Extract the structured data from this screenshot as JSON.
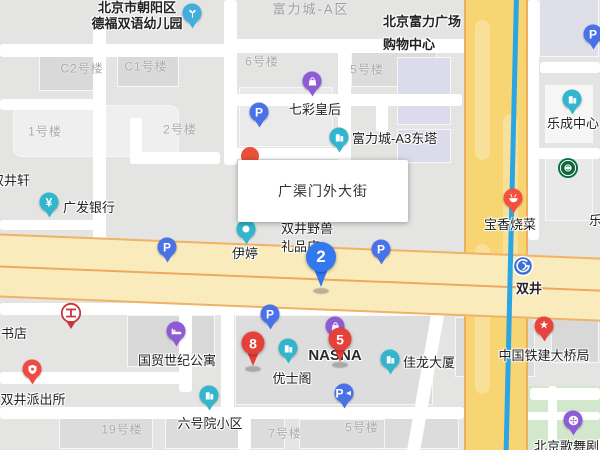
{
  "info_box": {
    "text": "广渠门外大街"
  },
  "colors": {
    "land": "#E4E4E3",
    "road_white": "#FFFFFF",
    "main_road_fill": "#F7D573",
    "main_road_casing": "#EFAF62",
    "cross_road_fill": "#FAEBBC",
    "road_centerline": "#EDA95E",
    "subway_line_blue": "#2AA6E4",
    "park_green": "#D2E7CC",
    "poi_teal": "#32B6CE",
    "poi_purple": "#8F5AD6",
    "parking_blue": "#4A72E8",
    "marker_red": "#E6403A",
    "marker_blue": "#3478F0",
    "icbc_red": "#C8353A",
    "starbucks_green": "#0A6C3C",
    "subway_icon_blue": "#3B6FD6",
    "building_label_gray": "#ABABAB"
  },
  "area_labels": [
    {
      "text": "富力城-A区",
      "x": 311,
      "y": 8
    }
  ],
  "building_labels": [
    {
      "text": "C2号楼",
      "x": 82,
      "y": 68
    },
    {
      "text": "C1号楼",
      "x": 146,
      "y": 66
    },
    {
      "text": "1号楼",
      "x": 45,
      "y": 131
    },
    {
      "text": "2号楼",
      "x": 180,
      "y": 129
    },
    {
      "text": "6号楼",
      "x": 262,
      "y": 61
    },
    {
      "text": "5号楼",
      "x": 367,
      "y": 69
    },
    {
      "text": "19号楼",
      "x": 122,
      "y": 429
    },
    {
      "text": "7号楼",
      "x": 285,
      "y": 433
    },
    {
      "text": "5号楼",
      "x": 362,
      "y": 427
    }
  ],
  "pois": [
    {
      "name": "北京市朝阳区\n德福双语幼儿园",
      "icon": "kindergarten",
      "color": "#41AEDC",
      "x": 192,
      "y": 13,
      "label_x": 137,
      "label_y": 16,
      "align": "center",
      "bold": true,
      "lh": 16
    },
    {
      "name": "七彩皇后",
      "icon": "shopping-bag",
      "color": "#8F5AD6",
      "x": 312,
      "y": 81,
      "label_x": 315,
      "label_y": 110,
      "align": "center"
    },
    {
      "name": "北京富力广场\n购物中心",
      "icon": "",
      "label_x": 383,
      "label_y": 33,
      "align": "left",
      "bold": true,
      "lh": 23
    },
    {
      "name": "富力城-A3东塔",
      "icon": "building",
      "color": "#32B6CE",
      "x": 339,
      "y": 137,
      "label_x": 352,
      "label_y": 139,
      "align": "left"
    },
    {
      "name": "乐成中心",
      "icon": "building",
      "color": "#32B6CE",
      "x": 572,
      "y": 99,
      "label_x": 573,
      "label_y": 124,
      "align": "center"
    },
    {
      "name": "",
      "icon": "starbucks",
      "x": 568,
      "y": 168
    },
    {
      "name": "双井轩",
      "icon": "",
      "label_x": -9,
      "label_y": 181,
      "align": "left"
    },
    {
      "name": "广发银行",
      "icon": "yuan",
      "color": "#32B6CE",
      "x": 49,
      "y": 202,
      "label_x": 63,
      "label_y": 208,
      "align": "left"
    },
    {
      "name": "伊婷",
      "icon": "dot",
      "color": "#32B6CE",
      "x": 246,
      "y": 229,
      "label_x": 245,
      "label_y": 254,
      "align": "center"
    },
    {
      "name": "双井野兽\n礼品店",
      "icon": "",
      "label_x": 281,
      "label_y": 238,
      "align": "left",
      "lh": 18
    },
    {
      "name": "宝香烧菜",
      "icon": "food",
      "color": "#F4503C",
      "x": 513,
      "y": 198,
      "label_x": 510,
      "label_y": 225,
      "align": "center"
    },
    {
      "name": "双井",
      "icon": "subway",
      "x": 523,
      "y": 266,
      "label_x": 529,
      "label_y": 289,
      "align": "center",
      "bold": true
    },
    {
      "name": "国贸世纪公寓",
      "icon": "bed",
      "color": "#8F5AD6",
      "x": 176,
      "y": 331,
      "label_x": 177,
      "label_y": 361,
      "align": "center"
    },
    {
      "name": "",
      "icon": "icbc",
      "x": 71,
      "y": 313
    },
    {
      "name": "书店",
      "icon": "",
      "label_x": 1,
      "label_y": 334,
      "align": "left"
    },
    {
      "name": "双井派出所",
      "icon": "police",
      "color": "#EF4B44",
      "x": 32,
      "y": 369,
      "label_x": 33,
      "label_y": 400,
      "align": "center"
    },
    {
      "name": "优士阁",
      "icon": "building",
      "color": "#32B6CE",
      "x": 288,
      "y": 348,
      "label_x": 292,
      "label_y": 379,
      "align": "center"
    },
    {
      "name": "NASNA",
      "icon": "shopping-bag",
      "color": "#8F5AD6",
      "x": 335,
      "y": 326,
      "label_x": 335,
      "label_y": 356,
      "align": "center",
      "latin": true
    },
    {
      "name": "佳龙大厦",
      "icon": "building",
      "color": "#32B6CE",
      "x": 390,
      "y": 359,
      "label_x": 403,
      "label_y": 363,
      "align": "left"
    },
    {
      "name": "中国铁建大桥局",
      "icon": "star",
      "color": "#E8433C",
      "x": 544,
      "y": 326,
      "label_x": 544,
      "label_y": 356,
      "align": "center"
    },
    {
      "name": "北京歌舞剧院",
      "icon": "film",
      "color": "#8F5AD6",
      "x": 573,
      "y": 420,
      "label_x": 573,
      "label_y": 447,
      "align": "center"
    },
    {
      "name": "六号院小区",
      "icon": "building",
      "color": "#32B6CE",
      "x": 209,
      "y": 395,
      "label_x": 210,
      "label_y": 424,
      "align": "center"
    },
    {
      "name": "乐",
      "icon": "",
      "label_x": 589,
      "label_y": 221,
      "align": "left"
    },
    {
      "name": "",
      "icon": "parking",
      "color": "#4A72E8",
      "x": 259,
      "y": 112
    },
    {
      "name": "",
      "icon": "parking",
      "color": "#4A72E8",
      "x": 167,
      "y": 247
    },
    {
      "name": "",
      "icon": "parking",
      "color": "#4A72E8",
      "x": 381,
      "y": 249
    },
    {
      "name": "",
      "icon": "parking",
      "color": "#4A72E8",
      "x": 270,
      "y": 314
    },
    {
      "name": "",
      "icon": "parking",
      "color": "#4A72E8",
      "x": 593,
      "y": 34
    },
    {
      "name": "",
      "icon": "parking-entrance",
      "color": "#4A72E8",
      "x": 344,
      "y": 393
    }
  ],
  "markers": [
    {
      "label": "2",
      "color": "#3478F0",
      "x": 321,
      "y": 257,
      "size": "large"
    },
    {
      "label": "8",
      "color": "#E6403A",
      "x": 253,
      "y": 343,
      "size": "small"
    },
    {
      "label": "5",
      "color": "#E6403A",
      "x": 340,
      "y": 339,
      "size": "small"
    }
  ]
}
